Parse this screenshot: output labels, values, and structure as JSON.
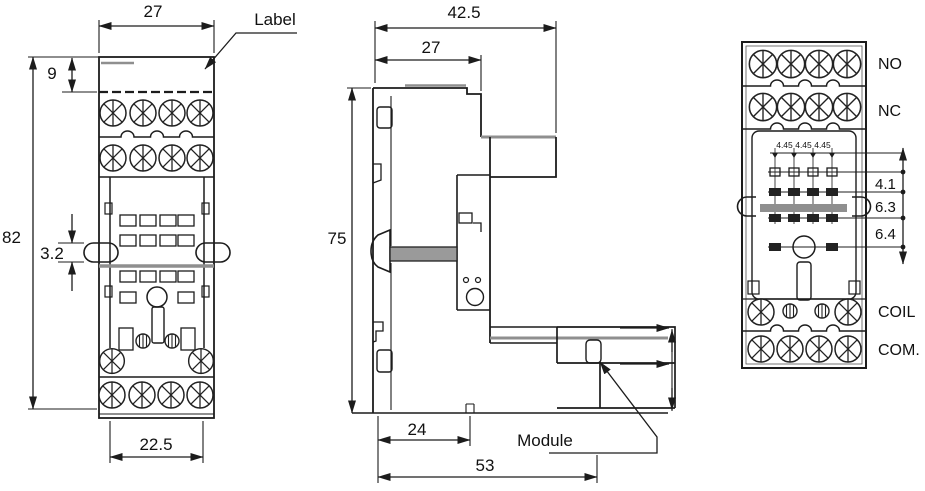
{
  "drawing": {
    "kind": "relay-socket-dimension-drawing",
    "colors": {
      "line": "#1c1c1c",
      "accent_gray": "#8f8f8f",
      "background": "#ffffff"
    },
    "front_view": {
      "callout": "Label",
      "dim_width_top": "27",
      "dim_label_height": "9",
      "dim_total_height": "82",
      "dim_clip": "3.2",
      "dim_width_bottom": "22.5"
    },
    "side_view": {
      "callout": "Module",
      "dim_depth_total": "42.5",
      "dim_depth_body": "27",
      "dim_height": "75",
      "dim_bottom_inner": "24",
      "dim_bottom_total": "53"
    },
    "bottom_view": {
      "row_label_no": "NO",
      "row_label_nc": "NC",
      "row_label_coil": "COIL",
      "row_label_com": "COM.",
      "pin_pitch": [
        "4.45",
        "4.45",
        "4.45"
      ],
      "dim_row_gap_1": "4.1",
      "dim_row_gap_2": "6.3",
      "dim_row_gap_3": "6.4"
    }
  }
}
